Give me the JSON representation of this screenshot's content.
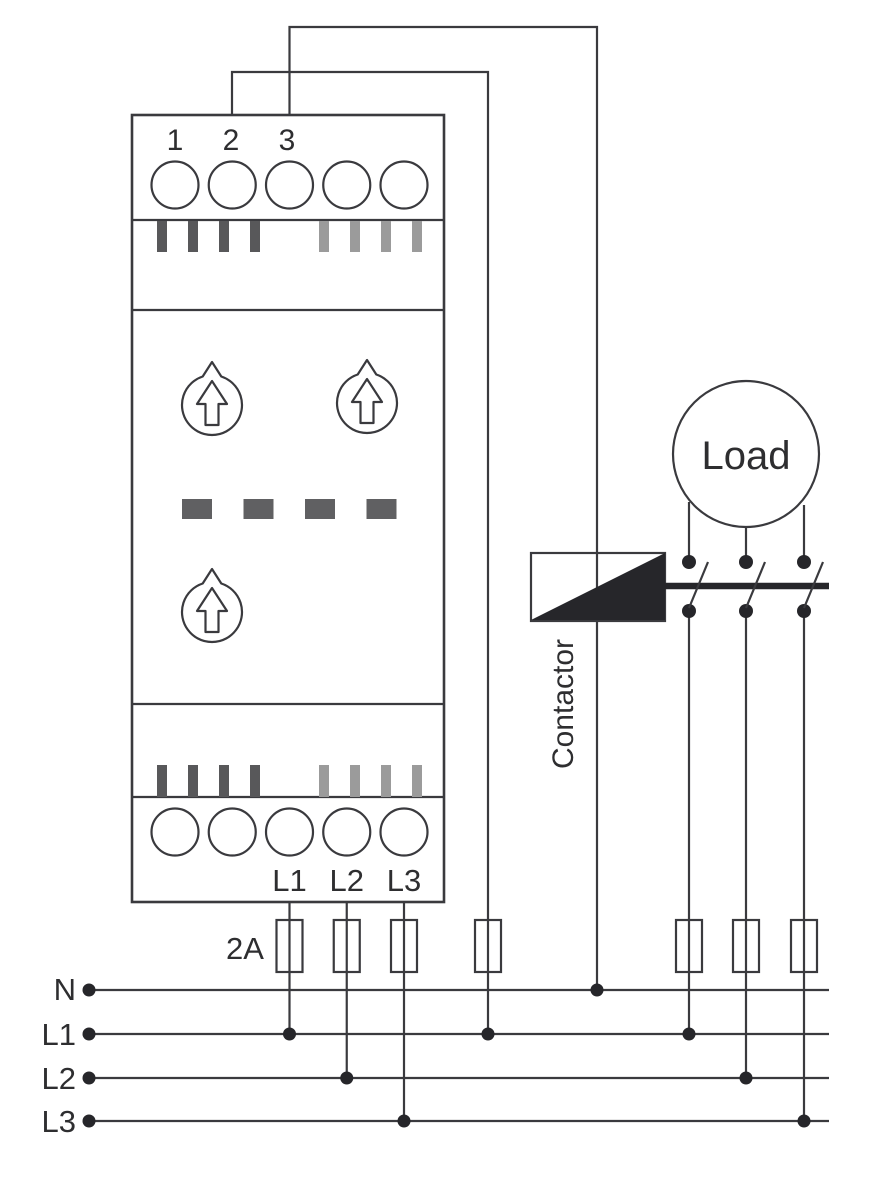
{
  "device": {
    "top_terminal_labels": [
      "1",
      "2",
      "3"
    ],
    "bottom_terminal_labels": [
      "L1",
      "L2",
      "L3"
    ],
    "top_terminal_count": 5,
    "bottom_terminal_count": 5,
    "knob_count": 3,
    "display_dash_count": 4
  },
  "fuse_rating": "2A",
  "contactor_label": "Contactor",
  "load_label": "Load",
  "bus_lines": [
    "N",
    "L1",
    "L2",
    "L3"
  ],
  "colors": {
    "line": "#3a3a3e",
    "black_fill": "#26262a",
    "stripe_dark": "#58585a",
    "stripe_light": "#9b9b9b",
    "display_dash": "#606062",
    "background": "#ffffff"
  }
}
